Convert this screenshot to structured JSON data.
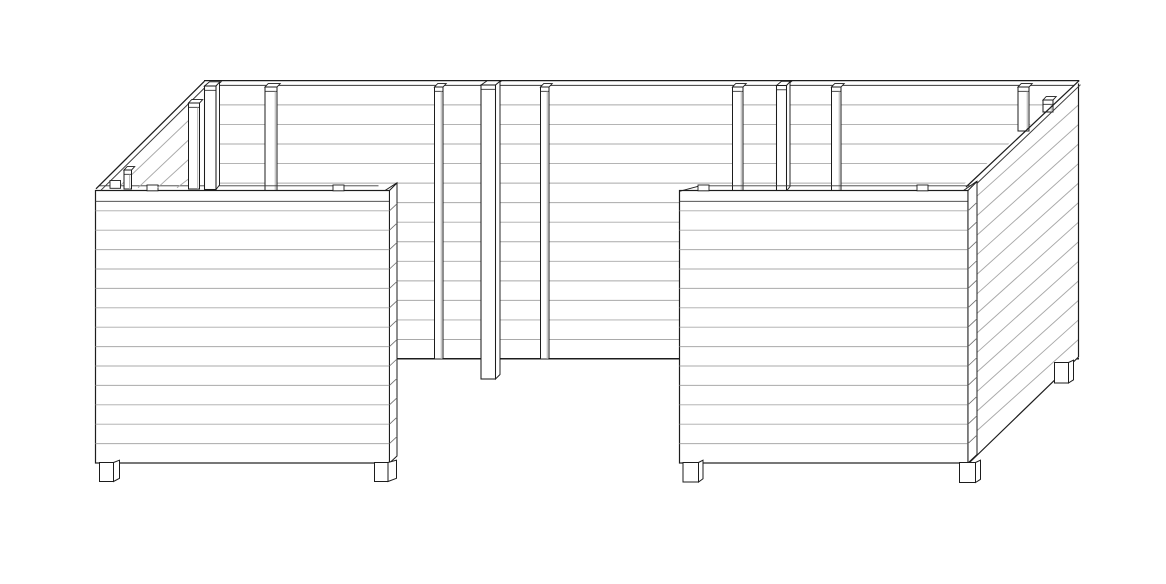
{
  "meta": {
    "title": "Technical line drawing of a U-shaped wooden raised garden bed",
    "view": "isometric front view, black outlines on white, no text labels",
    "components": {
      "back_wall_boards": 14,
      "front_panel_boards": 14,
      "side_wall_boards": 14,
      "vertical_battens": 9,
      "corner_posts": 3,
      "feet": 5
    }
  },
  "canvas": {
    "w": 1166,
    "h": 584
  },
  "colors": {
    "bg": "#ffffff",
    "outline": "#1d1d1d",
    "soft": "#3a3a3a",
    "slat": "#a9a9a9",
    "mid": "#707070",
    "fill": "#ffffff"
  },
  "drawing": {
    "groups": [
      {
        "name": "back-wall",
        "prims": [
          {
            "t": "l",
            "x1": 204,
            "y1": 80.6,
            "x2": 1079.2,
            "y2": 80.6,
            "c": "outline",
            "w": 1.3
          },
          {
            "t": "l",
            "x1": 207,
            "y1": 85.4,
            "x2": 1078.2,
            "y2": 85.4,
            "c": "soft",
            "w": 1
          },
          {
            "t": "hl",
            "x1": 204,
            "x2": 1079,
            "y0": 104.9,
            "dy": 19.55,
            "n": 13,
            "c": "slat",
            "w": 0.95
          },
          {
            "t": "l",
            "x1": 204,
            "y1": 358.8,
            "x2": 1079,
            "y2": 358.8,
            "c": "outline",
            "w": 1.5
          },
          {
            "t": "bat",
            "x": 265,
            "bw": 12,
            "top": 87,
            "bot": 191
          },
          {
            "t": "bat",
            "x": 434.5,
            "bw": 8.5,
            "top": 87,
            "bot": 359
          },
          {
            "t": "bat",
            "x": 540.5,
            "bw": 8.5,
            "top": 87,
            "bot": 359
          },
          {
            "t": "post",
            "x": 481,
            "bw": 14.5,
            "side": 4.5,
            "top": 85,
            "bot": 379
          },
          {
            "t": "bat",
            "x": 732.5,
            "bw": 10.5,
            "top": 87,
            "bot": 191
          },
          {
            "t": "post",
            "x": 776.5,
            "bw": 10,
            "side": 3.5,
            "top": 85.5,
            "bot": 191
          },
          {
            "t": "bat",
            "x": 831.5,
            "bw": 9.5,
            "top": 87,
            "bot": 191
          }
        ]
      },
      {
        "name": "right-side-wall",
        "prims": [
          {
            "t": "p",
            "pts": [
              [
                962,
                186
              ],
              [
                1079,
                80.6
              ],
              [
                1079,
                357
              ],
              [
                969,
                463.5
              ]
            ],
            "f": "fill",
            "c": "none"
          },
          {
            "t": "dg",
            "x1": 1078.5,
            "x2": 977.3,
            "y0": 104.9,
            "dy": 19.55,
            "n": 13,
            "off": 90.9,
            "c": "slat",
            "w": 0.95
          },
          {
            "t": "l",
            "x1": 1078.5,
            "y1": 83.5,
            "x2": 1078.5,
            "y2": 357,
            "c": "outline",
            "w": 1.2
          },
          {
            "t": "l",
            "x1": 1078.5,
            "y1": 357,
            "x2": 969,
            "y2": 463,
            "c": "outline",
            "w": 1.2
          },
          {
            "t": "bat",
            "x": 1018,
            "bw": 11,
            "top": 87,
            "bot": 131
          },
          {
            "t": "bat",
            "x": 1043,
            "bw": 10,
            "top": 100,
            "bot": 112
          },
          {
            "t": "l",
            "x1": 966,
            "y1": 187,
            "x2": 1079.2,
            "y2": 80.6,
            "c": "outline",
            "w": 1.25
          },
          {
            "t": "l",
            "x1": 969.5,
            "y1": 190.5,
            "x2": 1080.5,
            "y2": 84.7,
            "c": "soft",
            "w": 1
          },
          {
            "t": "foot",
            "x": 1054.5,
            "bw": 14,
            "top": 362.5,
            "bot": 383,
            "side": 5
          }
        ]
      },
      {
        "name": "left-front-panel",
        "prims": [
          {
            "t": "l",
            "x1": 99.5,
            "y1": 185.8,
            "x2": 378.5,
            "y2": 185.8,
            "c": "soft",
            "w": 0.9
          },
          {
            "t": "r",
            "x": 95.5,
            "y": 190.5,
            "rw": 294,
            "rh": 272.5,
            "f": "fill",
            "c": "outline",
            "sw": 1.2
          },
          {
            "t": "l",
            "x1": 95.5,
            "y1": 201.3,
            "x2": 389.5,
            "y2": 201.3,
            "c": "soft",
            "w": 0.9
          },
          {
            "t": "hl",
            "x1": 95.5,
            "x2": 389.5,
            "y0": 210.8,
            "dy": 19.4,
            "n": 13,
            "c": "slat",
            "w": 0.95
          },
          {
            "t": "r",
            "x": 147,
            "y": 185,
            "rw": 11,
            "rh": 5.8,
            "f": "fill",
            "c": "outline",
            "sw": 0.9
          },
          {
            "t": "r",
            "x": 333,
            "y": 185,
            "rw": 11,
            "rh": 5.8,
            "f": "fill",
            "c": "outline",
            "sw": 0.9
          },
          {
            "t": "p",
            "pts": [
              [
                389.5,
                190.5
              ],
              [
                397,
                183
              ],
              [
                397,
                456
              ],
              [
                389.5,
                463
              ]
            ],
            "f": "fill",
            "c": "outline",
            "sw": 1
          },
          {
            "t": "l",
            "x1": 385,
            "y1": 190.5,
            "x2": 397,
            "y2": 182.8,
            "c": "outline",
            "w": 1
          },
          {
            "t": "dg",
            "x1": 389.5,
            "x2": 397,
            "y0": 210.8,
            "dy": 19.4,
            "n": 13,
            "off": -7,
            "c": "mid",
            "w": 0.85
          },
          {
            "t": "foot",
            "x": 99.5,
            "bw": 14,
            "top": 462.5,
            "bot": 481.5,
            "side": 6
          },
          {
            "t": "foot",
            "x": 374.5,
            "bw": 13.5,
            "top": 462.5,
            "bot": 481.5,
            "side": 8.5
          }
        ]
      },
      {
        "name": "right-front-panel",
        "prims": [
          {
            "t": "l",
            "x1": 700,
            "y1": 185.8,
            "x2": 971.5,
            "y2": 185.8,
            "c": "soft",
            "w": 0.9
          },
          {
            "t": "r",
            "x": 679.5,
            "y": 190.5,
            "rw": 288.5,
            "rh": 272.5,
            "f": "fill",
            "c": "outline",
            "sw": 1.2
          },
          {
            "t": "l",
            "x1": 679.5,
            "y1": 191.3,
            "x2": 700,
            "y2": 185.8,
            "c": "outline",
            "w": 1
          },
          {
            "t": "l",
            "x1": 679.5,
            "y1": 201.3,
            "x2": 968,
            "y2": 201.3,
            "c": "soft",
            "w": 0.9
          },
          {
            "t": "hl",
            "x1": 679.5,
            "x2": 968,
            "y0": 210.8,
            "dy": 19.4,
            "n": 13,
            "c": "slat",
            "w": 0.95
          },
          {
            "t": "r",
            "x": 698,
            "y": 185,
            "rw": 11,
            "rh": 5.8,
            "f": "fill",
            "c": "outline",
            "sw": 0.9
          },
          {
            "t": "r",
            "x": 917,
            "y": 185,
            "rw": 11,
            "rh": 5.8,
            "f": "fill",
            "c": "outline",
            "sw": 0.9
          },
          {
            "t": "p",
            "pts": [
              [
                968,
                190.5
              ],
              [
                977,
                181.5
              ],
              [
                977,
                454.5
              ],
              [
                968,
                463
              ]
            ],
            "f": "fill",
            "c": "outline",
            "sw": 1
          },
          {
            "t": "l",
            "x1": 963.5,
            "y1": 190.5,
            "x2": 977,
            "y2": 181.2,
            "c": "outline",
            "w": 1
          },
          {
            "t": "dg",
            "x1": 968,
            "x2": 977,
            "y0": 210.8,
            "dy": 19.4,
            "n": 13,
            "off": -8.5,
            "c": "mid",
            "w": 0.85
          },
          {
            "t": "foot",
            "x": 683,
            "bw": 15.5,
            "top": 462.5,
            "bot": 482,
            "side": 4.5
          },
          {
            "t": "foot",
            "x": 959.5,
            "bw": 16,
            "top": 462.5,
            "bot": 482.5,
            "side": 5
          }
        ]
      },
      {
        "name": "left-side-wall-rim",
        "prims": [
          {
            "t": "l",
            "x1": 96,
            "y1": 188.8,
            "x2": 204.5,
            "y2": 81.2,
            "c": "outline",
            "w": 1.25
          },
          {
            "t": "l",
            "x1": 101,
            "y1": 190.2,
            "x2": 207.5,
            "y2": 85,
            "c": "soft",
            "w": 1
          },
          {
            "t": "l",
            "x1": 118,
            "y1": 187.8,
            "x2": 188.5,
            "y2": 120.5,
            "c": "slat",
            "w": 0.95
          },
          {
            "t": "l",
            "x1": 138,
            "y1": 187.8,
            "x2": 188.5,
            "y2": 140,
            "c": "slat",
            "w": 0.95
          },
          {
            "t": "l",
            "x1": 157.5,
            "y1": 187.8,
            "x2": 188.5,
            "y2": 159.5,
            "c": "slat",
            "w": 0.95
          },
          {
            "t": "l",
            "x1": 177,
            "y1": 187.8,
            "x2": 188.5,
            "y2": 179,
            "c": "slat",
            "w": 0.95
          },
          {
            "t": "bat",
            "x": 188.5,
            "bw": 11,
            "top": 103,
            "bot": 189
          },
          {
            "t": "post",
            "x": 204.5,
            "bw": 11.5,
            "side": 3.5,
            "top": 86,
            "bot": 189.5
          },
          {
            "t": "bat",
            "x": 124,
            "bw": 7.5,
            "top": 170,
            "bot": 189
          },
          {
            "t": "r",
            "x": 110,
            "y": 180.5,
            "rw": 10.5,
            "rh": 7.8,
            "f": "fill",
            "c": "outline",
            "sw": 0.9
          }
        ]
      }
    ]
  }
}
